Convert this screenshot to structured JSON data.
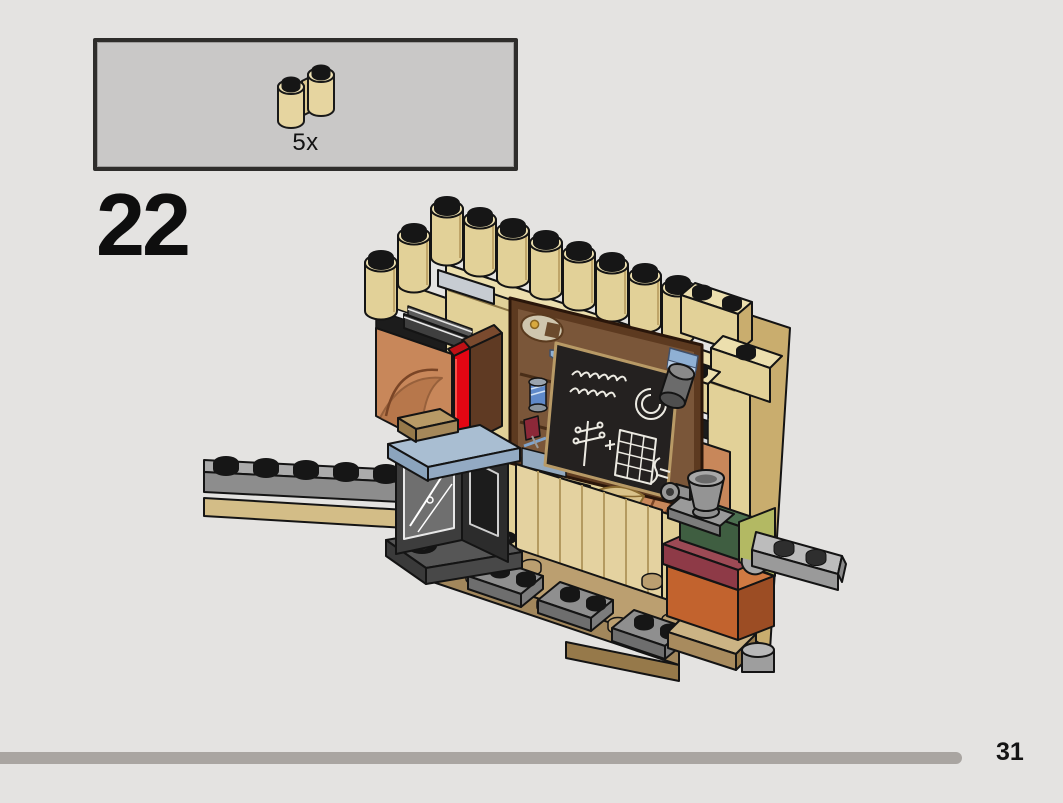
{
  "page": {
    "number": "31",
    "background_color": "#e4e3e1",
    "progress_bar_color": "#a9a5a1"
  },
  "step": {
    "number": "22"
  },
  "parts_callout": {
    "box_fill": "#c9c8c7",
    "border_color": "#2e2d2b",
    "parts": [
      {
        "name": "brick-1x2-log-palisade",
        "color_name": "tan",
        "color_hex": "#e2d198",
        "quantity_label": "5x"
      }
    ]
  },
  "illustration": {
    "description": "Isometric view of a partially built LEGO wall: tan log-brick battlement top, printed chalkboard classroom panel with white chalk drawings, medium-nougat arch walls, red and brown book pieces, dark-gray lantern window box with sand-blue plate, long gray plates, and dark green, olive, dark red and dark orange bricks on tan base plates.",
    "palette": {
      "tan": "#e2d198",
      "tan_light": "#ecdfae",
      "tan_shadow": "#c9ad6e",
      "dark_tan": "#bb9f70",
      "dark_tan_shadow": "#a2875c",
      "nougat": "#c8875a",
      "nougat_shadow": "#a3643a",
      "red": "#e30613",
      "dark_red_brick": "#8e3a47",
      "brown": "#5f3a23",
      "sand_blue": "#a9bed2",
      "dark_green": "#3f5e41",
      "olive_green": "#b3b963",
      "dark_orange": "#c2632e",
      "light_gray": "#bcbcbc",
      "gray": "#9a9a9a",
      "dark_gray": "#3d3d3d",
      "black": "#161616",
      "board_frame_brown": "#5d3a20",
      "board_black": "#242120",
      "chalk_white": "#eceae2",
      "bulb_yellow": "#ecc869",
      "spool_blue": "#5f89c9"
    }
  }
}
